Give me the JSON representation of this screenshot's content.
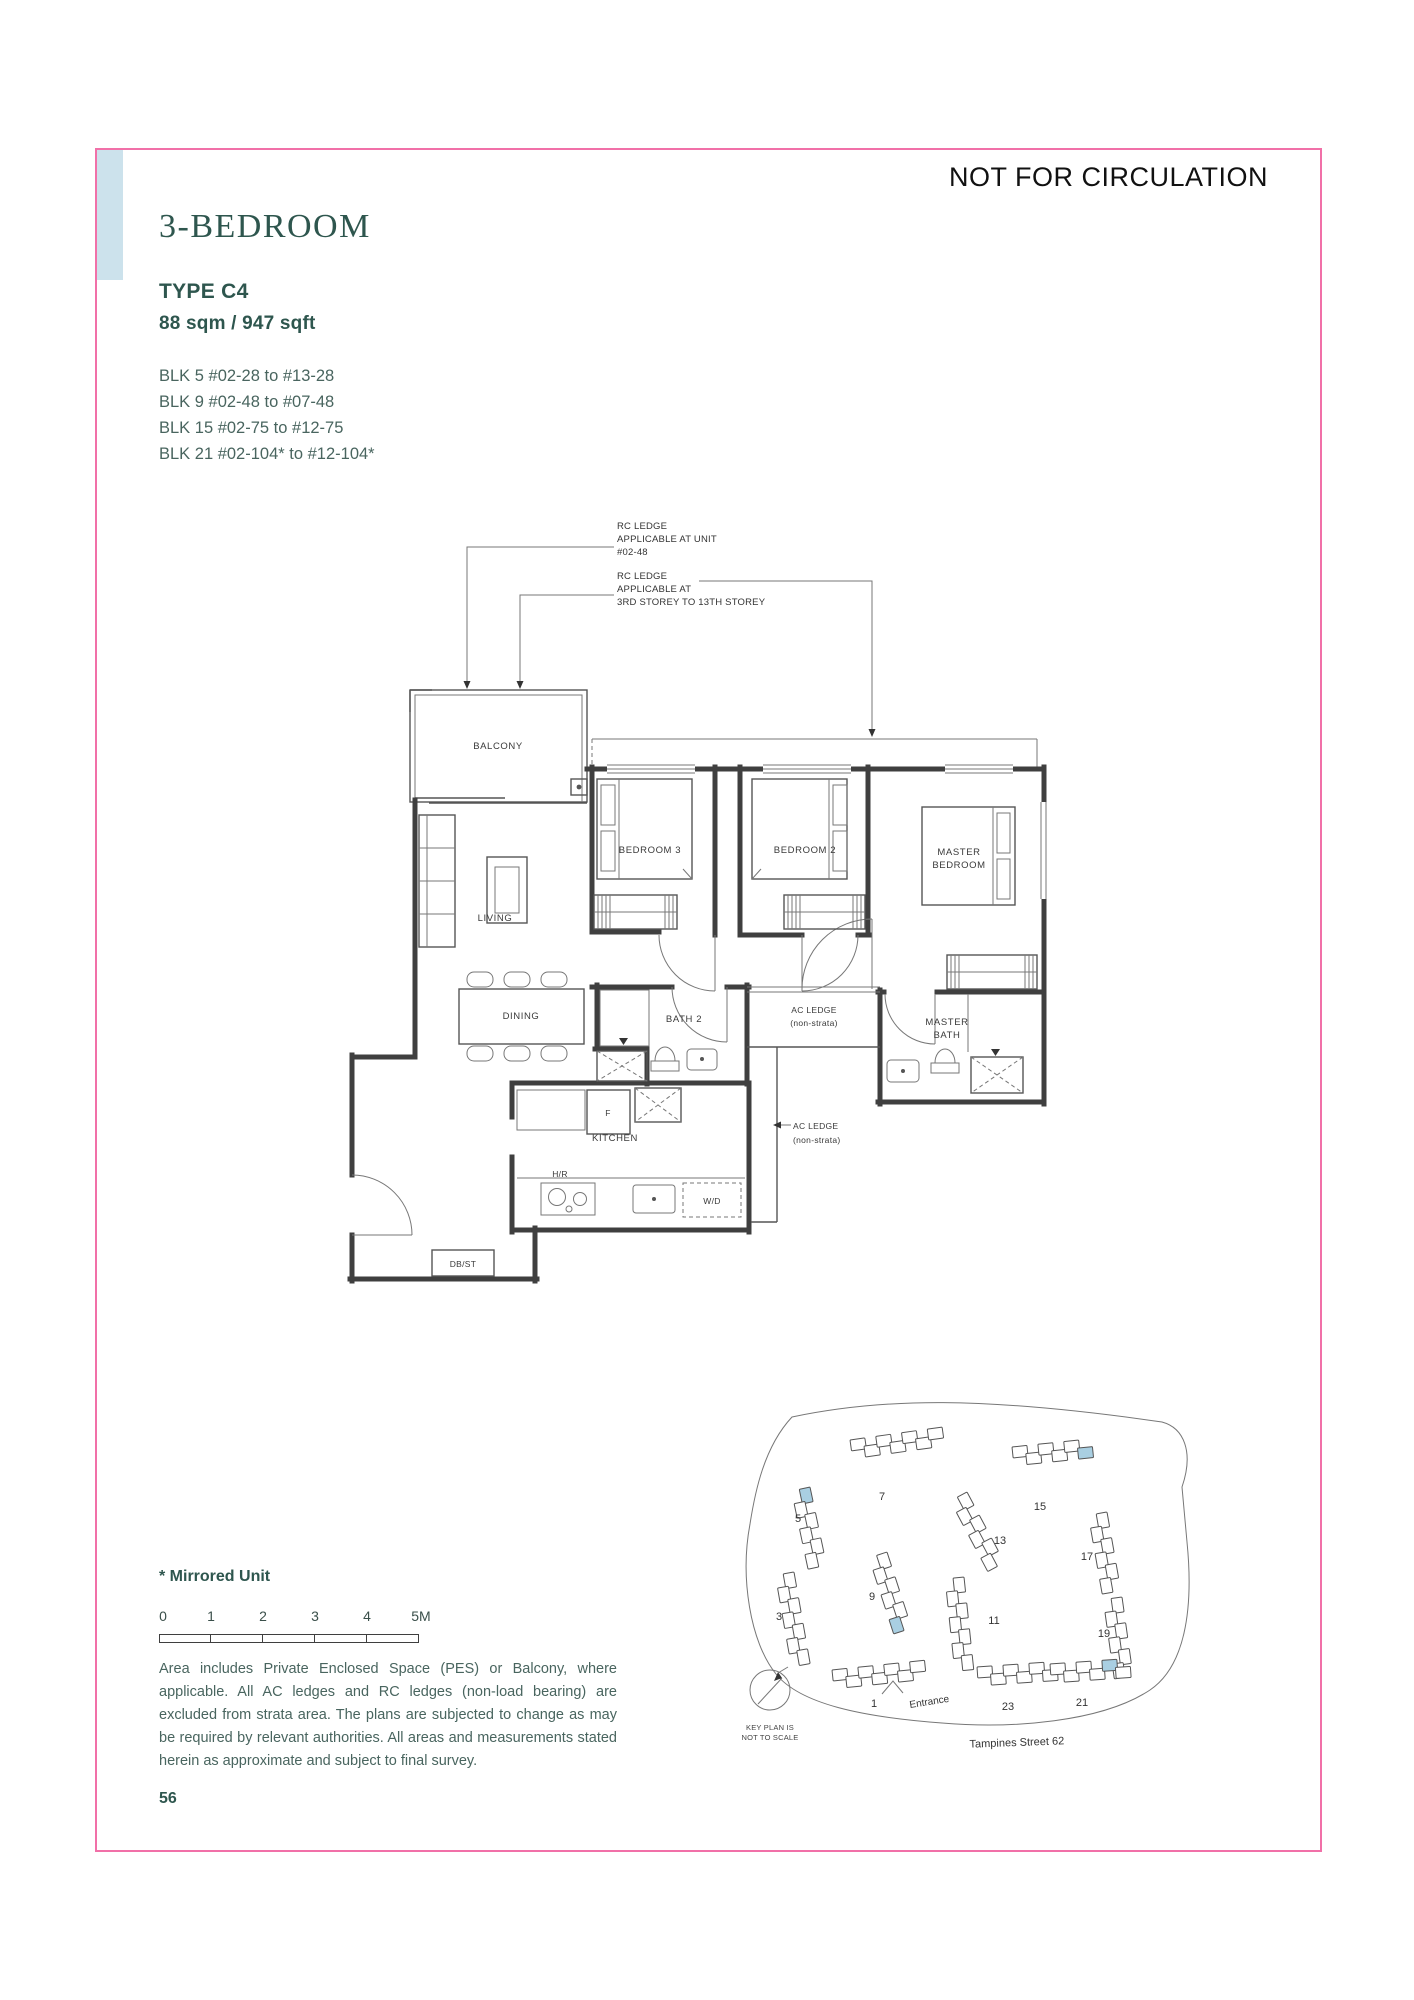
{
  "page": {
    "stamp": "NOT FOR CIRCULATION",
    "number": "56"
  },
  "header": {
    "title": "3-BEDROOM",
    "type": "TYPE C4",
    "area": "88 sqm / 947 sqft",
    "blocks": [
      "BLK 5 #02-28 to #13-28",
      "BLK 9 #02-48 to #07-48",
      "BLK 15 #02-75 to #12-75",
      "BLK 21 #02-104* to #12-104*"
    ]
  },
  "annotations": {
    "rc1": "RC LEDGE\nAPPLICABLE AT UNIT\n#02-48",
    "rc2": "RC LEDGE\nAPPLICABLE AT\n3RD STOREY TO 13TH STOREY"
  },
  "plan": {
    "balcony": "BALCONY",
    "living": "LIVING",
    "dining": "DINING",
    "bed3": "BEDROOM 3",
    "bed2": "BEDROOM 2",
    "master_l1": "MASTER",
    "master_l2": "BEDROOM",
    "bath2": "BATH 2",
    "mbath_l1": "MASTER",
    "mbath_l2": "BATH",
    "kitchen": "KITCHEN",
    "ac1_l1": "AC LEDGE",
    "ac1_l2": "(non-strata)",
    "ac2_l1": "AC LEDGE",
    "ac2_l2": "(non-strata)",
    "dbst": "DB/ST",
    "fridge": "F",
    "wd": "W/D",
    "hob": "H/R"
  },
  "footer": {
    "mirrored": "* Mirrored Unit",
    "scale_labels": [
      "0",
      "1",
      "2",
      "3",
      "4",
      "5M"
    ],
    "disclaimer": "Area includes Private Enclosed Space (PES) or Balcony, where applicable. All AC ledges and RC ledges (non-load bearing) are excluded from strata area. The plans are subjected to change as may be required by relevant authorities. All areas and measurements stated herein as approximate and subject to final survey."
  },
  "keyplan": {
    "note_l1": "KEY PLAN IS",
    "note_l2": "NOT TO SCALE",
    "entrance": "Entrance",
    "street": "Tampines Street 62",
    "clusters": [
      {
        "label": "7",
        "x": 168,
        "y": 48,
        "rot": -8,
        "n": 7,
        "hl": -1,
        "lx": 200,
        "ly": 108
      },
      {
        "label": "15",
        "x": 330,
        "y": 55,
        "rot": -6,
        "n": 6,
        "hl": 5,
        "lx": 358,
        "ly": 118
      },
      {
        "label": "5",
        "x": 128,
        "y": 95,
        "rot": 78,
        "n": 6,
        "hl": 0,
        "lx": 116,
        "ly": 130
      },
      {
        "label": "13",
        "x": 285,
        "y": 100,
        "rot": 62,
        "n": 6,
        "hl": -1,
        "lx": 318,
        "ly": 152
      },
      {
        "label": "17",
        "x": 425,
        "y": 120,
        "rot": 80,
        "n": 6,
        "hl": -1,
        "lx": 405,
        "ly": 168
      },
      {
        "label": "9",
        "x": 205,
        "y": 160,
        "rot": 72,
        "n": 6,
        "hl": 5,
        "lx": 190,
        "ly": 208
      },
      {
        "label": "11",
        "x": 282,
        "y": 185,
        "rot": 84,
        "n": 7,
        "hl": -1,
        "lx": 312,
        "ly": 232
      },
      {
        "label": "3",
        "x": 112,
        "y": 180,
        "rot": 80,
        "n": 7,
        "hl": -1,
        "lx": 97,
        "ly": 228
      },
      {
        "label": "19",
        "x": 440,
        "y": 205,
        "rot": 82,
        "n": 6,
        "hl": -1,
        "lx": 422,
        "ly": 245
      },
      {
        "label": "1",
        "x": 150,
        "y": 278,
        "rot": -6,
        "n": 7,
        "hl": -1,
        "lx": 192,
        "ly": 315
      },
      {
        "label": "23",
        "x": 295,
        "y": 275,
        "rot": -4,
        "n": 6,
        "hl": -1,
        "lx": 326,
        "ly": 318
      },
      {
        "label": "21",
        "x": 368,
        "y": 272,
        "rot": -4,
        "n": 6,
        "hl": 4,
        "lx": 400,
        "ly": 314
      }
    ]
  },
  "colors": {
    "accent_pink": "#F170A8",
    "accent_blue": "#CCE2EC",
    "heading_teal": "#2E564E",
    "highlight_unit": "#A9CFE2"
  }
}
